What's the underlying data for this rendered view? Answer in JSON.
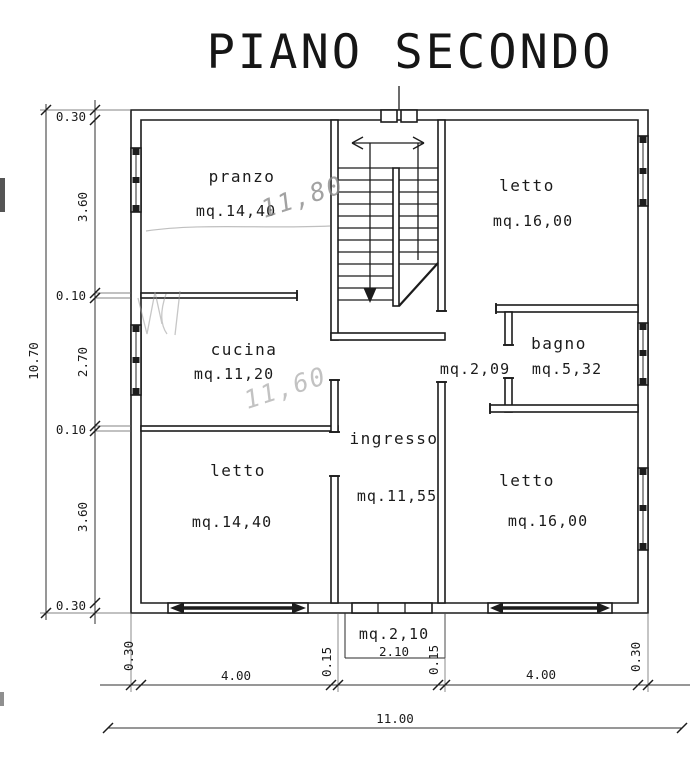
{
  "title": "PIANO SECONDO",
  "rooms": {
    "pranzo": {
      "name": "pranzo",
      "area": "mq.14,40",
      "pencil_note": "11,80"
    },
    "letto_ne": {
      "name": "letto",
      "area": "mq.16,00"
    },
    "cucina": {
      "name": "cucina",
      "area": "mq.11,20",
      "pencil_note": "11,60"
    },
    "corridoio": {
      "area": "mq.2,09"
    },
    "bagno": {
      "name": "bagno",
      "area": "mq.5,32"
    },
    "ingresso": {
      "name": "ingresso",
      "area": "mq.11,55"
    },
    "letto_sw": {
      "name": "letto",
      "area": "mq.14,40"
    },
    "letto_se": {
      "name": "letto",
      "area": "mq.16,00"
    },
    "balcone": {
      "area": "mq.2,10"
    }
  },
  "dimensions": {
    "left": {
      "total": "10.70",
      "segments": [
        "0.30",
        "3.60",
        "0.10",
        "2.70",
        "0.10",
        "3.60",
        "0.30"
      ]
    },
    "bottom": {
      "total": "11.00",
      "segments": [
        "0.30",
        "4.00",
        "0.15",
        "2.10",
        "0.15",
        "4.00",
        "0.30"
      ]
    }
  },
  "colors": {
    "line": "#1c1c1c",
    "pencil": "#8c8c8c",
    "paper": "#ffffff"
  }
}
